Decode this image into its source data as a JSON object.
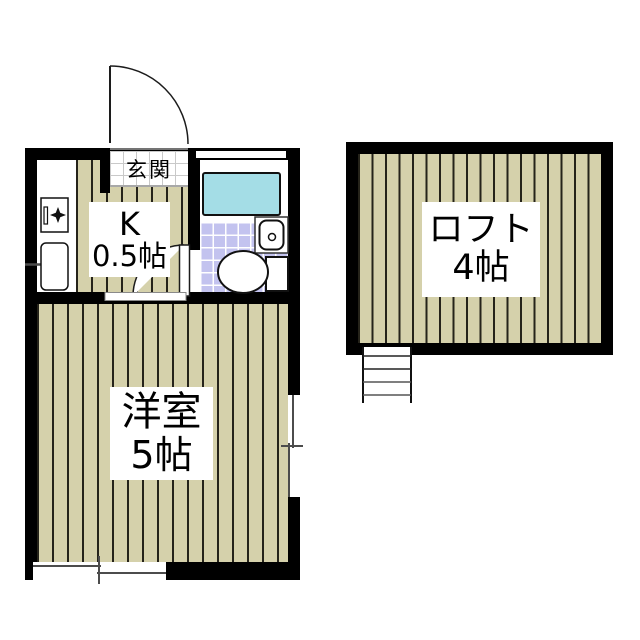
{
  "meta": {
    "type": "floor-plan"
  },
  "rooms": {
    "entrance": {
      "label": "玄関"
    },
    "kitchen": {
      "name": "K",
      "size": "0.5帖"
    },
    "western_room": {
      "name": "洋室",
      "size": "5帖"
    },
    "loft": {
      "name": "ロフト",
      "size": "4帖"
    }
  },
  "icons": {
    "entrance_door": "quarter-circle swing door",
    "bathroom_door": "quarter-circle swing door",
    "stove": "stove box with burner star",
    "kitchen_sink": "sink with faucet line",
    "bathtub": "rectangular tub",
    "hand_basin": "small wash basin with drain circle",
    "toilet": "toilet bowl with tank",
    "ladder": "loft ladder with rungs",
    "window_bottom": "sliding window symbol with cross tick",
    "window_right": "sliding window symbol with cross tick"
  },
  "colors": {
    "wall": "#000000",
    "plank": "#d5d1ab",
    "plank-line": "#25231a",
    "bath-tile": "#c3c3ef",
    "tile-line": "#ffffff",
    "bathtub": "#a4dde6",
    "genkan-line": "#c9c9c9",
    "symbol": "#4c4c4c",
    "bg": "#ffffff"
  }
}
